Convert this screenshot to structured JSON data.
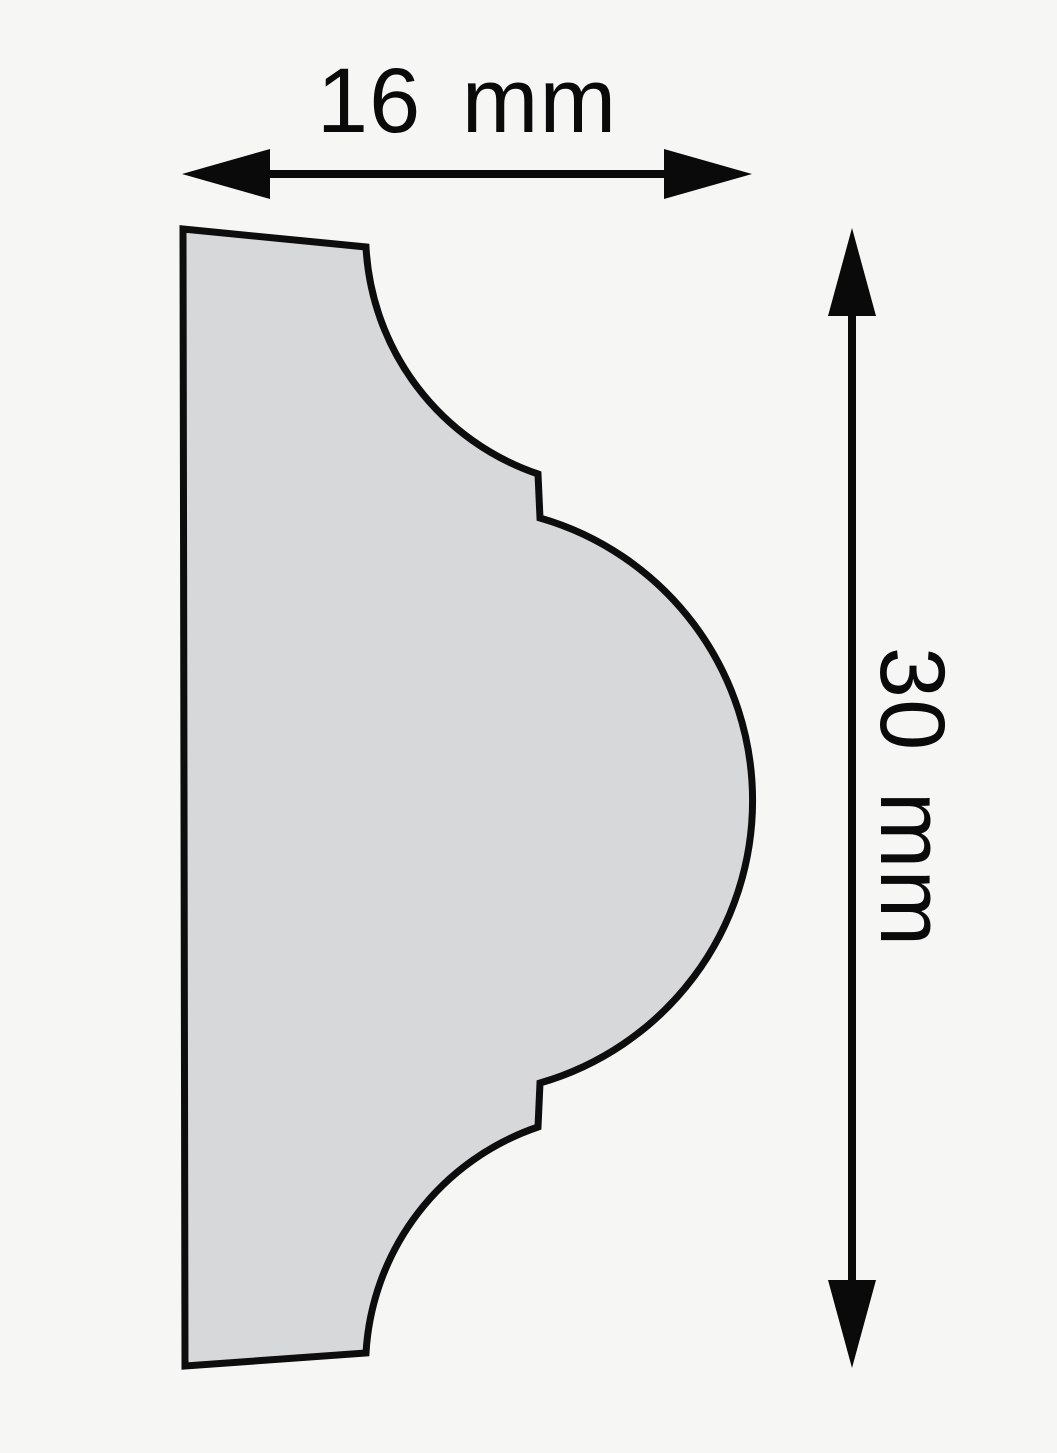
{
  "diagram": {
    "type": "molding-profile-cross-section",
    "description": "2D cross-section drawing of a decorative molding profile (flat back, cove - fillet step - convex torus bulge - fillet step - cove face) with two dimension arrows",
    "width_dimension": {
      "label": "16 mm",
      "value": 16,
      "unit": "mm",
      "orientation": "horizontal",
      "position": "top"
    },
    "height_dimension": {
      "label": "30 mm",
      "value": 30,
      "unit": "mm",
      "orientation": "vertical",
      "position": "right",
      "text_rotation_deg": 90
    },
    "colors": {
      "background": "#f6f6f5",
      "profile_fill": "#d7d8d9",
      "outline": "#0d0d0d",
      "dimension_ink": "#0a0a0a"
    }
  }
}
